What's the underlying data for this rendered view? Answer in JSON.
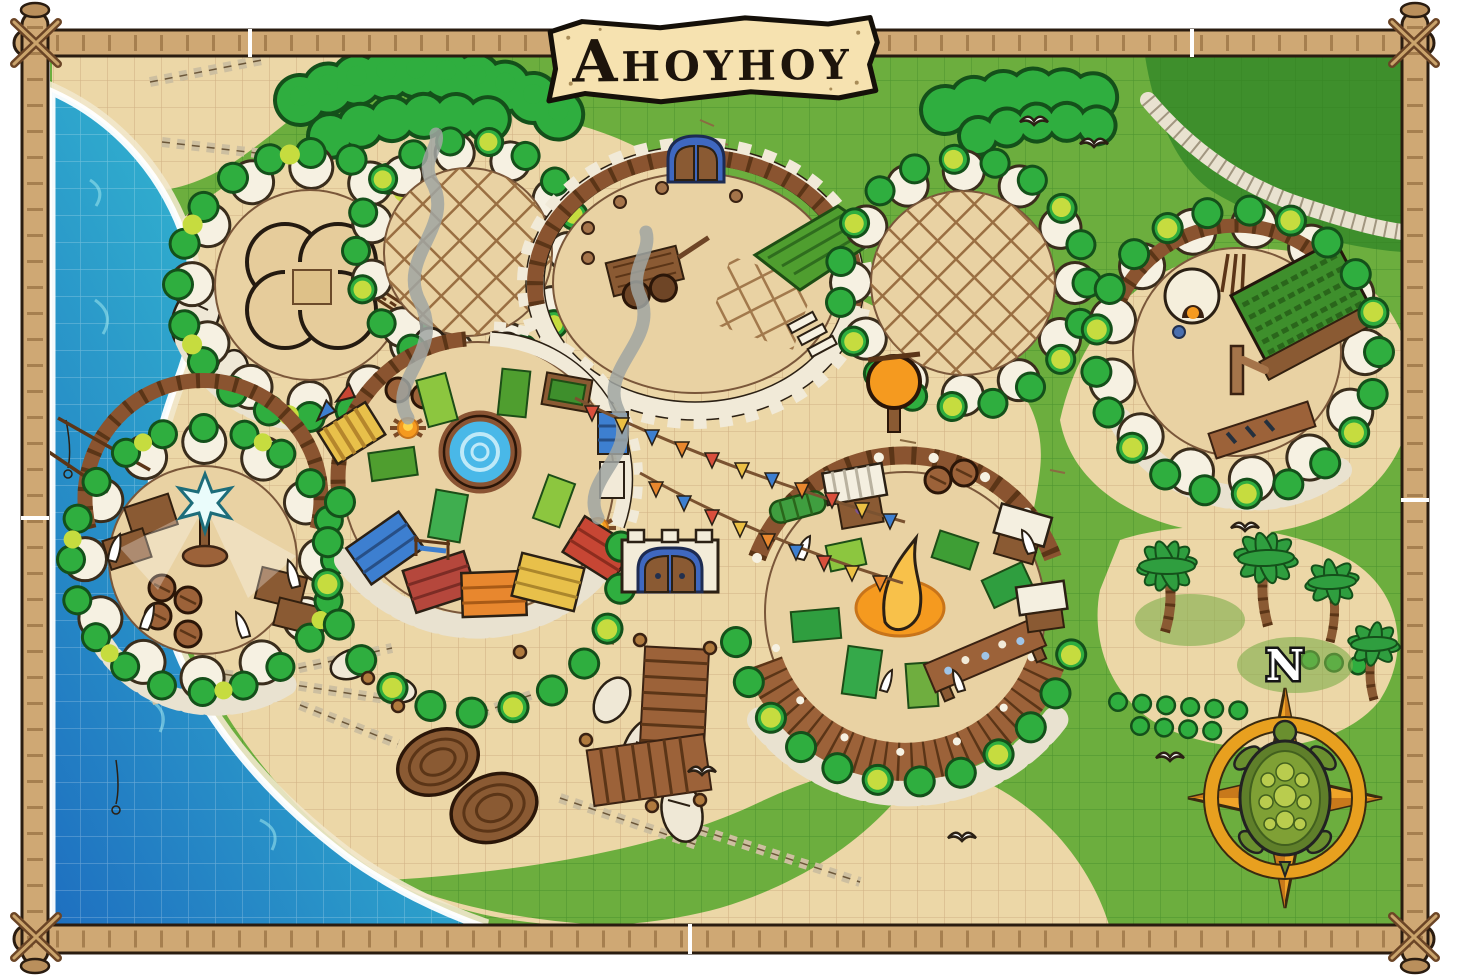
{
  "map": {
    "title": {
      "text": "Ahoyhoy",
      "first_letter": "A",
      "rest": "HOYHOY"
    },
    "compass": {
      "label": "N",
      "style": "four-point-star-with-sea-turtle"
    },
    "palette": {
      "grass": "#6cae3e",
      "grass-dark": "#3e8f2c",
      "sand": "#ecd7a7",
      "compound-floor": "#e9d2a3",
      "sea-deep": "#1e6fc0",
      "sea-mid": "#2fa9cd",
      "sea-shallow": "#49ccd8",
      "bamboo": "#cfa874",
      "parchment": "#f6e2b0",
      "wood-dark": "#6e4526",
      "wood-mid": "#9c6239",
      "wall-stone": "#f3ecd9",
      "bush-green": "#2fae3f",
      "bush-yellow": "#c6dc3f",
      "awning-blue": "#3d7fd0",
      "awning-red": "#c74634",
      "awning-maroon": "#b5473c",
      "awning-orange": "#e8872e",
      "awning-yellow": "#e8c04a",
      "fire-orange": "#f59a1f",
      "pool-water": "#49b8e8",
      "gate-blue": "#3f68c0",
      "compass-gold": "#f0a429",
      "turtle-shell": "#5f7f2a",
      "turtle-plate": "#b9cc4e"
    },
    "terrain": [
      "ocean",
      "beach-sand",
      "grassland",
      "highland-cliff-plateau"
    ],
    "grid": {
      "visible": true,
      "cell_px": 27
    },
    "features": [
      "bamboo-lashed-frame",
      "title-banner",
      "clover-fort",
      "trellis-compound-west",
      "arena-compound-with-gate",
      "trellis-compound-east",
      "garden-compound",
      "fishing-compound-with-star-beacon",
      "market-compound-with-pool-and-firepits",
      "boardwalk-compound-with-central-flame",
      "gatehouse-blue-doors",
      "flag-bunting-strings",
      "round-coracle-boats",
      "wooden-piers",
      "palm-grove",
      "turtle-compass-rose",
      "seagulls",
      "smoke-columns"
    ]
  }
}
